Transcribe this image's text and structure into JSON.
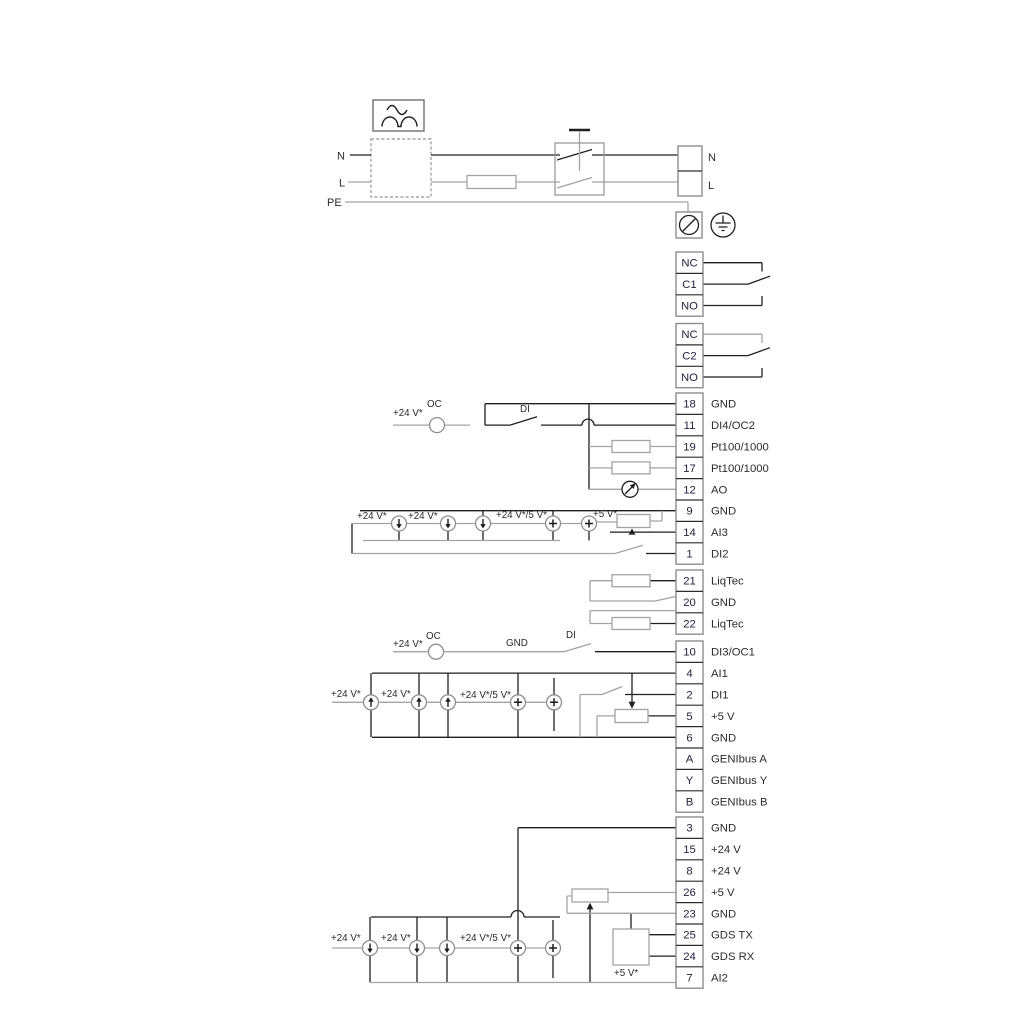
{
  "title": "Pump terminal wiring diagram",
  "power": {
    "left_labels": {
      "n": "N",
      "l": "L",
      "pe": "PE"
    },
    "right_labels": {
      "n": "N",
      "l": "L"
    }
  },
  "relays": [
    {
      "terminals": [
        "NC",
        "C1",
        "NO"
      ]
    },
    {
      "terminals": [
        "NC",
        "C2",
        "NO"
      ]
    }
  ],
  "terminal_groups": [
    {
      "name": "io-top",
      "terminals": [
        {
          "num": "18",
          "label": "GND"
        },
        {
          "num": "11",
          "label": "DI4/OC2"
        },
        {
          "num": "19",
          "label": "Pt100/1000"
        },
        {
          "num": "17",
          "label": "Pt100/1000"
        },
        {
          "num": "12",
          "label": "AO"
        },
        {
          "num": "9",
          "label": "GND"
        },
        {
          "num": "14",
          "label": "AI3"
        },
        {
          "num": "1",
          "label": "DI2"
        }
      ]
    },
    {
      "name": "liqtec",
      "terminals": [
        {
          "num": "21",
          "label": "LiqTec"
        },
        {
          "num": "20",
          "label": "GND"
        },
        {
          "num": "22",
          "label": "LiqTec"
        }
      ]
    },
    {
      "name": "io-mid",
      "terminals": [
        {
          "num": "10",
          "label": "DI3/OC1"
        },
        {
          "num": "4",
          "label": "AI1"
        },
        {
          "num": "2",
          "label": "DI1"
        },
        {
          "num": "5",
          "label": "+5 V"
        },
        {
          "num": "6",
          "label": "GND"
        },
        {
          "num": "A",
          "label": "GENIbus A"
        },
        {
          "num": "Y",
          "label": "GENIbus Y"
        },
        {
          "num": "B",
          "label": "GENIbus B"
        }
      ]
    },
    {
      "name": "io-bottom",
      "terminals": [
        {
          "num": "3",
          "label": "GND"
        },
        {
          "num": "15",
          "label": "+24 V"
        },
        {
          "num": "8",
          "label": "+24 V"
        },
        {
          "num": "26",
          "label": "+5 V"
        },
        {
          "num": "23",
          "label": "GND"
        },
        {
          "num": "25",
          "label": "GDS TX"
        },
        {
          "num": "24",
          "label": "GDS RX"
        },
        {
          "num": "7",
          "label": "AI2"
        }
      ]
    }
  ],
  "annotations": {
    "v24": "+24 V*",
    "v24_or_5": "+24 V*/5 V*",
    "v5": "+5 V*",
    "oc": "OC",
    "di": "DI",
    "gnd": "GND"
  },
  "colors": {
    "wire_black": "#1f1f1f",
    "wire_gray": "#a3a3a3",
    "box_gray": "#8d8d8d",
    "text": "#2b2b2b",
    "number_text": "#23233f"
  }
}
